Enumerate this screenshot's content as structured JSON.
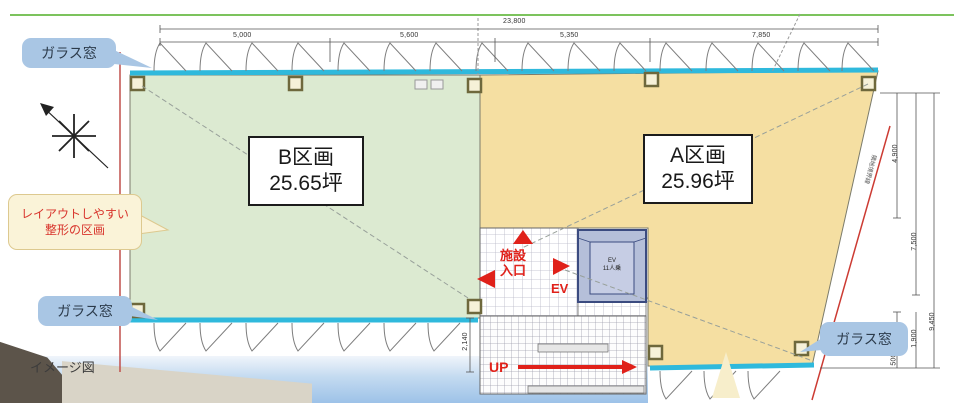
{
  "plan": {
    "units": [
      {
        "name": "B区画",
        "area": "25.65坪"
      },
      {
        "name": "A区画",
        "area": "25.96坪"
      }
    ],
    "callouts": {
      "glass_window": "ガラス窓",
      "layout_note_line1": "レイアウトしやすい",
      "layout_note_line2": "整形の区画",
      "image_caption": "イメージ図"
    },
    "core": {
      "entrance_line1": "施設",
      "entrance_line2": "入口",
      "ev": "EV",
      "up": "UP",
      "ev_cab_line1": "EV",
      "ev_cab_line2": "11人乗"
    },
    "walk_notes": {
      "b": "歩行距離=15.8m",
      "a_upper": "歩行距離=15.6m",
      "a_lower": "歩行距離=15.7m"
    },
    "boundary_note": "隣地境界線",
    "dimensions": {
      "total": "23,800",
      "top": [
        "5,000",
        "5,600",
        "5,350",
        "7,850"
      ],
      "right": [
        "4,900",
        "7,500",
        "9,450"
      ],
      "right_lower": [
        "1,400",
        "1,900",
        "500"
      ],
      "stair": "2,140"
    },
    "colors": {
      "compartment_b": "#dcead1",
      "compartment_a": "#f5dfa2",
      "glass": "#2fb9dc",
      "accent_red": "#e0211a",
      "bubble_blue": "#a9c6e4",
      "note_cream": "#faf3d8",
      "ev_fill": "#b5bfd9"
    }
  }
}
